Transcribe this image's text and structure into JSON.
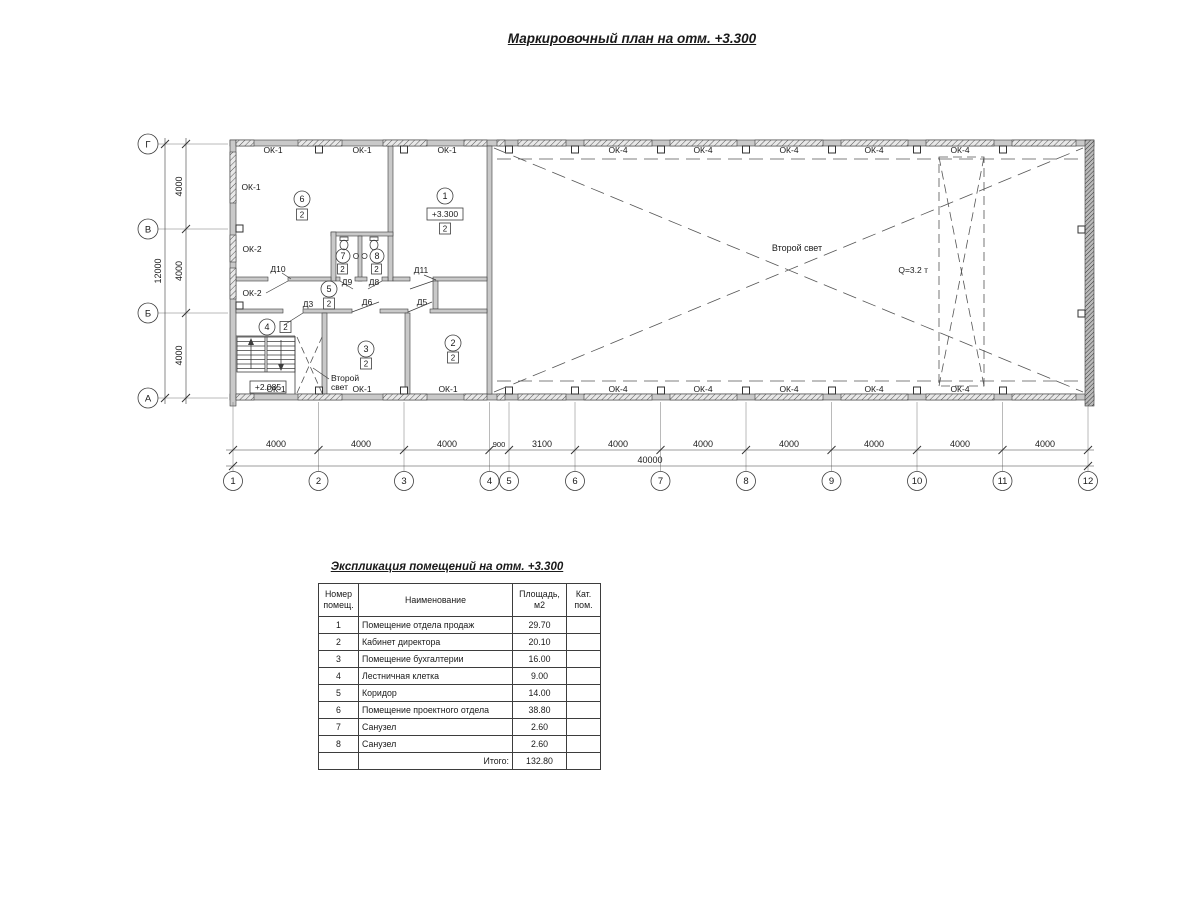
{
  "drawing_title": "Маркировочный план на отм. +3.300",
  "plan": {
    "axis_cols": [
      "1",
      "2",
      "3",
      "4",
      "5",
      "6",
      "7",
      "8",
      "9",
      "10",
      "11",
      "12"
    ],
    "axis_rows": [
      "Г",
      "В",
      "Б",
      "А"
    ],
    "dims_bottom": [
      "4000",
      "4000",
      "4000",
      "900",
      "3100",
      "4000",
      "4000",
      "4000",
      "4000",
      "4000",
      "4000"
    ],
    "dim_bottom_total": "40000",
    "dims_left": [
      "4000",
      "4000",
      "4000"
    ],
    "dim_left_total": "12000",
    "windows": {
      "ok1": "ОК-1",
      "ok2": "ОК-2",
      "ok4": "ОК-4"
    },
    "doors": [
      "Д10",
      "Д9",
      "Д8",
      "Д11",
      "Д3",
      "Д6",
      "Д5"
    ],
    "rooms": [
      {
        "num": "1",
        "cat": "2"
      },
      {
        "num": "2",
        "cat": "2"
      },
      {
        "num": "3",
        "cat": "2"
      },
      {
        "num": "4",
        "cat": "2"
      },
      {
        "num": "5",
        "cat": "2"
      },
      {
        "num": "6",
        "cat": "2"
      },
      {
        "num": "7",
        "cat": "2"
      },
      {
        "num": "8",
        "cat": "2"
      }
    ],
    "levels": {
      "floor": "+3.300",
      "stair": "+2.085"
    },
    "second_light": {
      "full": "Второй свет",
      "line1": "Второй",
      "line2": "свет"
    },
    "crane_capacity": "Q=3.2 т"
  },
  "explication": {
    "title": "Экспликация помещений на отм. +3.300",
    "headers": {
      "num": "Номер\nпомещ.",
      "name": "Наименование",
      "area": "Площадь,\nм2",
      "cat": "Кат.\nпом."
    },
    "rows": [
      {
        "num": "1",
        "name": "Помещение отдела продаж",
        "area": "29.70",
        "cat": ""
      },
      {
        "num": "2",
        "name": "Кабинет директора",
        "area": "20.10",
        "cat": ""
      },
      {
        "num": "3",
        "name": "Помещение бухгалтерии",
        "area": "16.00",
        "cat": ""
      },
      {
        "num": "4",
        "name": "Лестничная клетка",
        "area": "9.00",
        "cat": ""
      },
      {
        "num": "5",
        "name": "Коридор",
        "area": "14.00",
        "cat": ""
      },
      {
        "num": "6",
        "name": "Помещение проектного отдела",
        "area": "38.80",
        "cat": ""
      },
      {
        "num": "7",
        "name": "Санузел",
        "area": "2.60",
        "cat": ""
      },
      {
        "num": "8",
        "name": "Санузел",
        "area": "2.60",
        "cat": ""
      }
    ],
    "total_label": "Итого:",
    "total_area": "132.80"
  }
}
